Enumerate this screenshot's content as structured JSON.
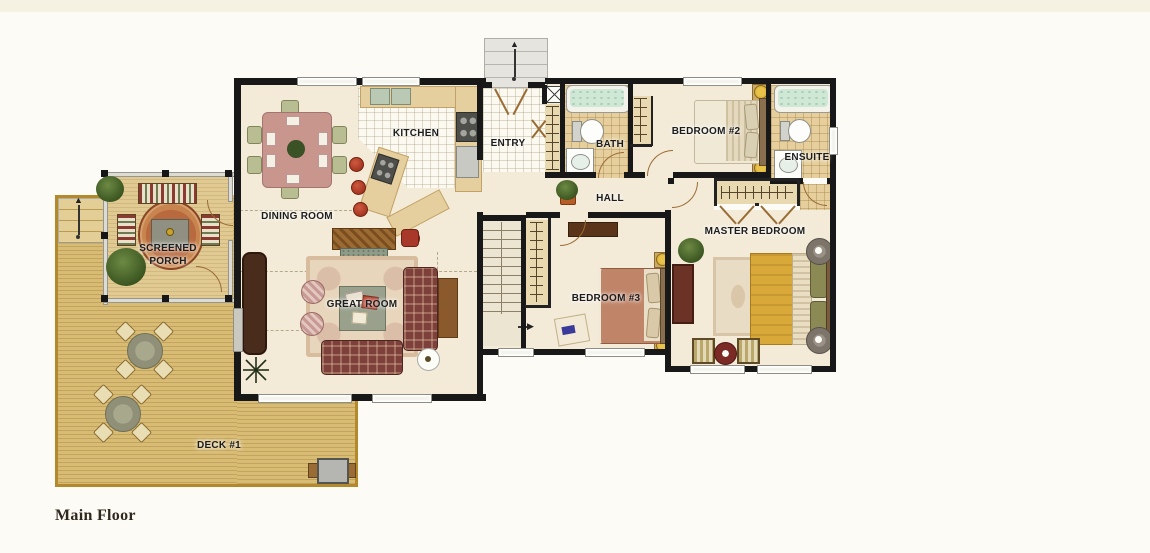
{
  "title": "Main Floor house plan",
  "rooms": {
    "kitchen": {
      "label": "KITCHEN"
    },
    "entry": {
      "label": "ENTRY"
    },
    "bath": {
      "label": "BATH"
    },
    "bedroom2": {
      "label": "BEDROOM #2"
    },
    "ensuite": {
      "label": "ENSUITE"
    },
    "dining_room": {
      "label": "DINING ROOM"
    },
    "hall": {
      "label": "HALL"
    },
    "screened_porch": {
      "line1": "SCREENED",
      "line2": "PORCH"
    },
    "master_bedroom": {
      "label": "MASTER BEDROOM"
    },
    "great_room": {
      "label": "GREAT ROOM"
    },
    "bedroom3": {
      "label": "BEDROOM #3"
    },
    "deck": {
      "label": "DECK #1"
    }
  },
  "footer": {
    "title": "Main Floor"
  },
  "icons": {
    "up_arrow_glyph": "▲",
    "right_arrow_glyph": "▶"
  },
  "colors": {
    "wall": "#181818",
    "floor_cream": "#f3ebd8",
    "deck_wood": "#d9bc74",
    "deck_border": "#b3892c",
    "porch_wood": "#e0ca92",
    "tile_tan": "#e6cf9c",
    "tile_white": "#fbf9f0",
    "tub_water": "#cfe8d6",
    "sofa_plaid": "#7e403a",
    "master_bed_gold": "#d8a838",
    "bed3_salmon": "#c08468",
    "bed2_cream": "#f0e9d6",
    "dining_table_mauve": "#c9968e",
    "label_text": "#1c1c1c",
    "page_background": "#fcfbf5"
  }
}
